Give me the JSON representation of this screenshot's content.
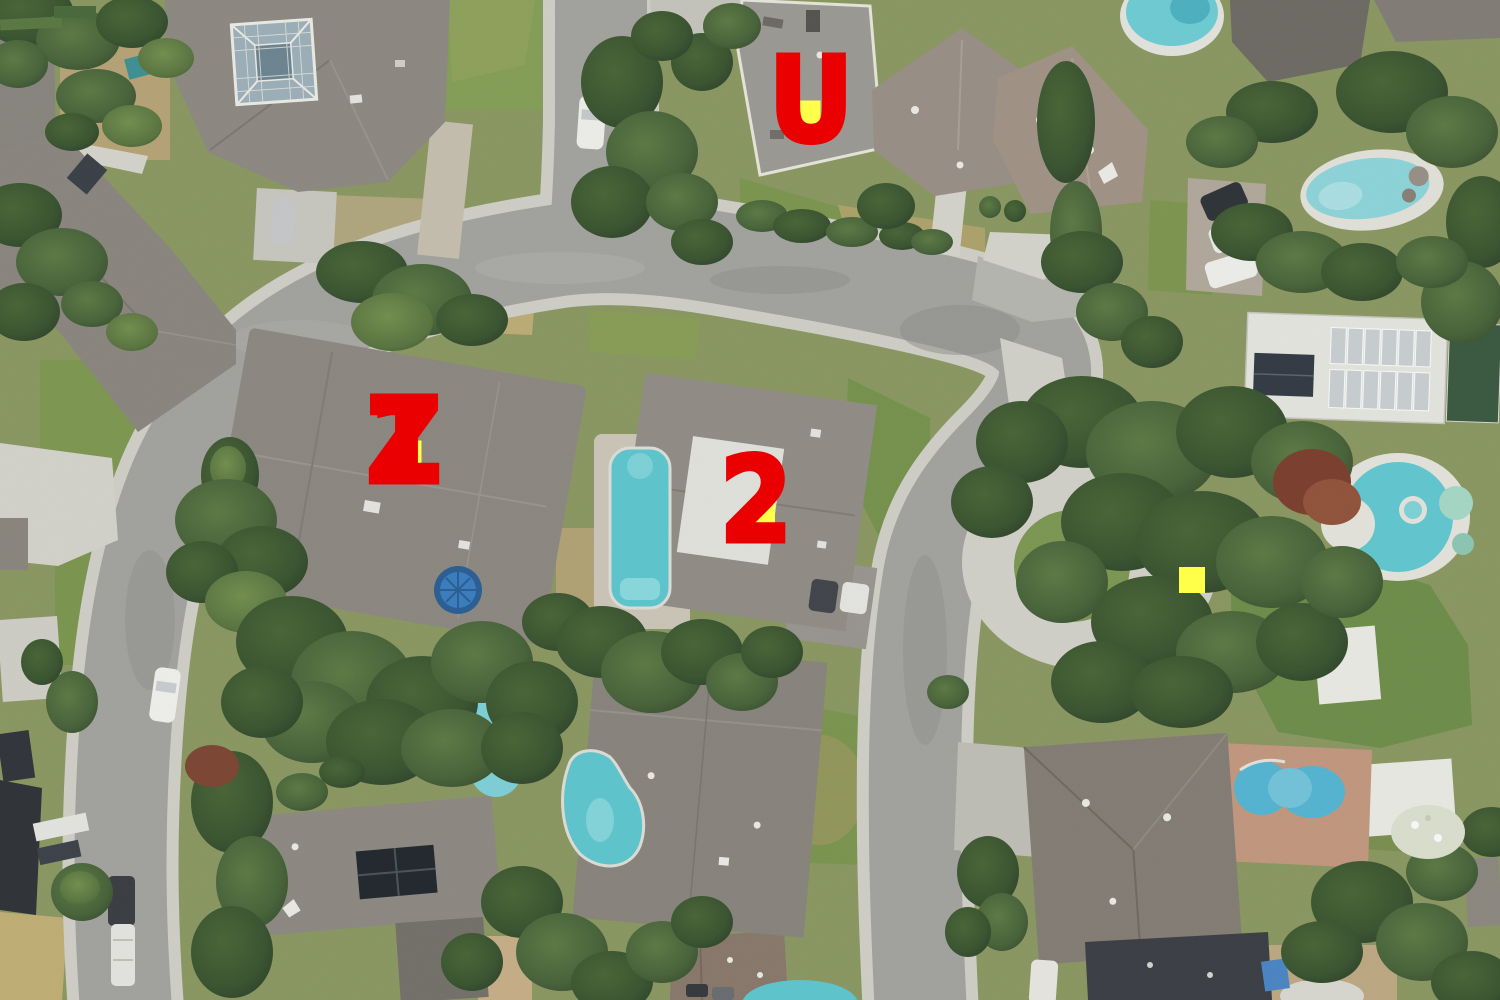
{
  "scene": {
    "type": "aerial-satellite-photo",
    "palette": {
      "road": "#a5a5a1",
      "sidewalk": "#d3d3cb",
      "concrete": "#d7d7cf",
      "roof_grey": "#8e8a83",
      "roof_brown": "#9a9088",
      "roof_dark": "#3b3f45",
      "tree_dark": "#3c5a33",
      "tree_mid": "#4a6b3b",
      "lawn": "#7d9850",
      "dry_grass": "#c0b078",
      "pool": "#5fc9d2",
      "brick": "#c59a80"
    }
  },
  "markers": {
    "red": "#ea0000",
    "yellow": "#ffff4a",
    "items": [
      {
        "id": "U",
        "letters": [
          "U"
        ],
        "letter_x": 811,
        "letter_y": 100,
        "square_x": 807,
        "square_y": 114,
        "square_size": 27
      },
      {
        "id": "Z1",
        "letters": [
          "Z",
          "1"
        ],
        "letter_x": 404,
        "letter_y": 441,
        "square_x": 408,
        "square_y": 454,
        "square_size": 27
      },
      {
        "id": "2",
        "letters": [
          "2"
        ],
        "letter_x": 756,
        "letter_y": 500,
        "square_x": 762,
        "square_y": 512,
        "square_size": 26
      },
      {
        "id": "square-only",
        "letters": [],
        "square_x": 1192,
        "square_y": 580,
        "square_size": 26
      }
    ]
  }
}
